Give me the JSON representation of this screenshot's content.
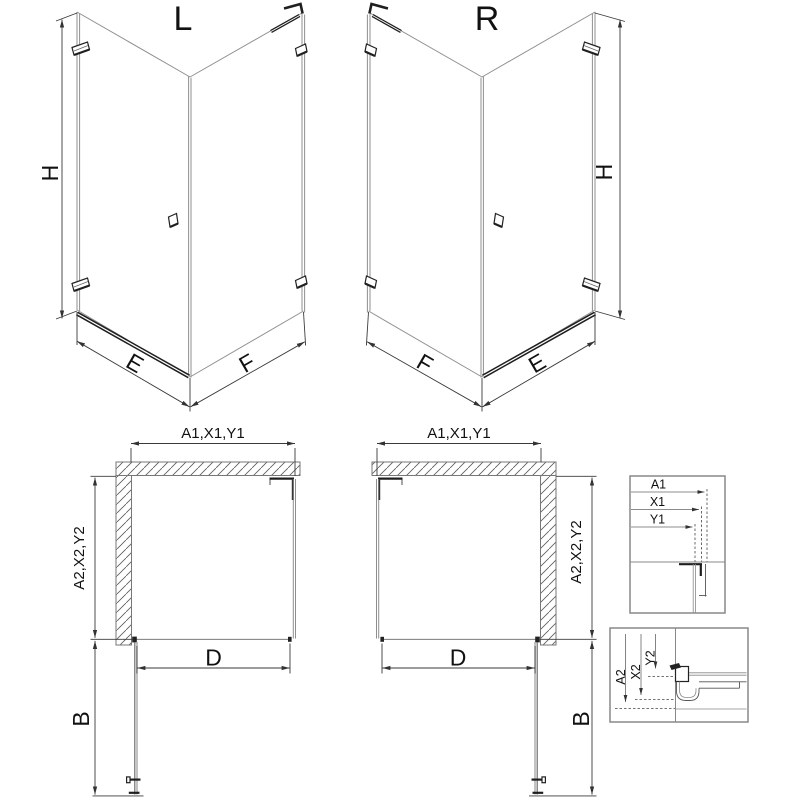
{
  "colors": {
    "background": "#ffffff",
    "line_gray": "#8f8f8f",
    "line_dark": "#3a3a3a",
    "accent_dark": "#1f1f1f",
    "hatch": "#5a5a5a",
    "box_border": "#888888",
    "text": "#111111"
  },
  "iso_left": {
    "variant_label": "L",
    "height_label": "H",
    "door_width_label": "E",
    "panel_width_label": "F"
  },
  "iso_right": {
    "variant_label": "R",
    "height_label": "H",
    "door_width_label": "E",
    "panel_width_label": "F"
  },
  "plan_left": {
    "width_dim_label": "A1,X1,Y1",
    "depth_dim_label": "A2,X2,Y2",
    "door_clearance_label": "D",
    "door_swing_label": "B"
  },
  "plan_right": {
    "width_dim_label": "A1,X1,Y1",
    "depth_dim_label": "A2,X2,Y2",
    "door_clearance_label": "D",
    "door_swing_label": "B"
  },
  "detail_width": {
    "dim_labels": [
      "A1",
      "X1",
      "Y1"
    ]
  },
  "detail_depth": {
    "dim_labels": [
      "A2",
      "X2",
      "Y2"
    ]
  }
}
